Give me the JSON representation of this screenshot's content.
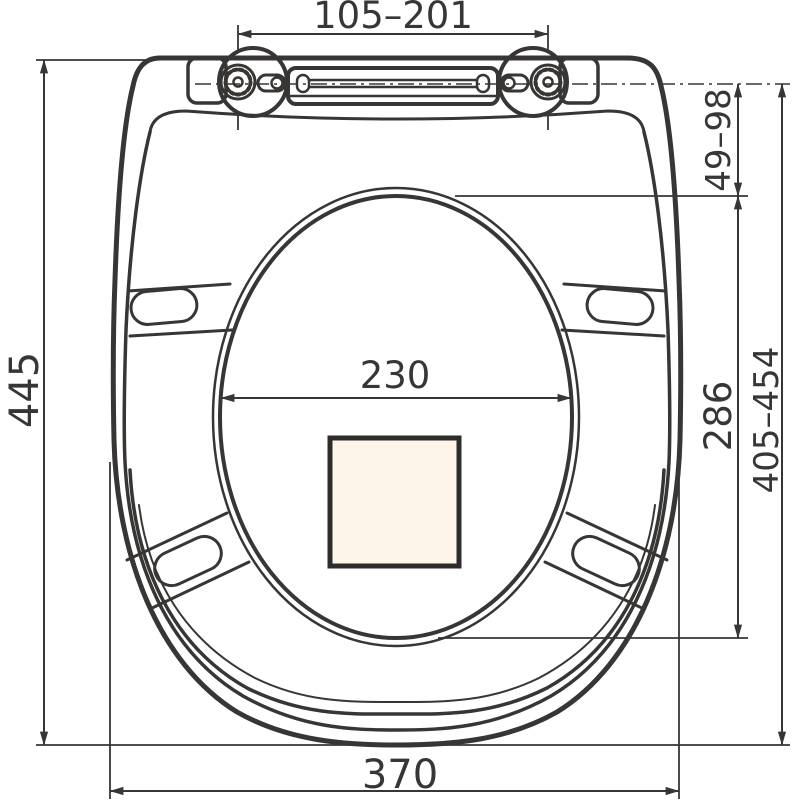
{
  "drawing": {
    "type": "technical-dimension-drawing",
    "subject": "toilet-seat-top-view",
    "dimensions": {
      "hinge_spacing": "105–201",
      "overall_length": "445",
      "overall_width": "370",
      "hinge_axis_to_opening": "49–98",
      "opening_length": "286",
      "opening_width": "230",
      "mounting_length_range": "405–454"
    },
    "colors": {
      "ink": "#383634",
      "cutout_fill": "#fdf5ea",
      "background": "#ffffff"
    }
  }
}
